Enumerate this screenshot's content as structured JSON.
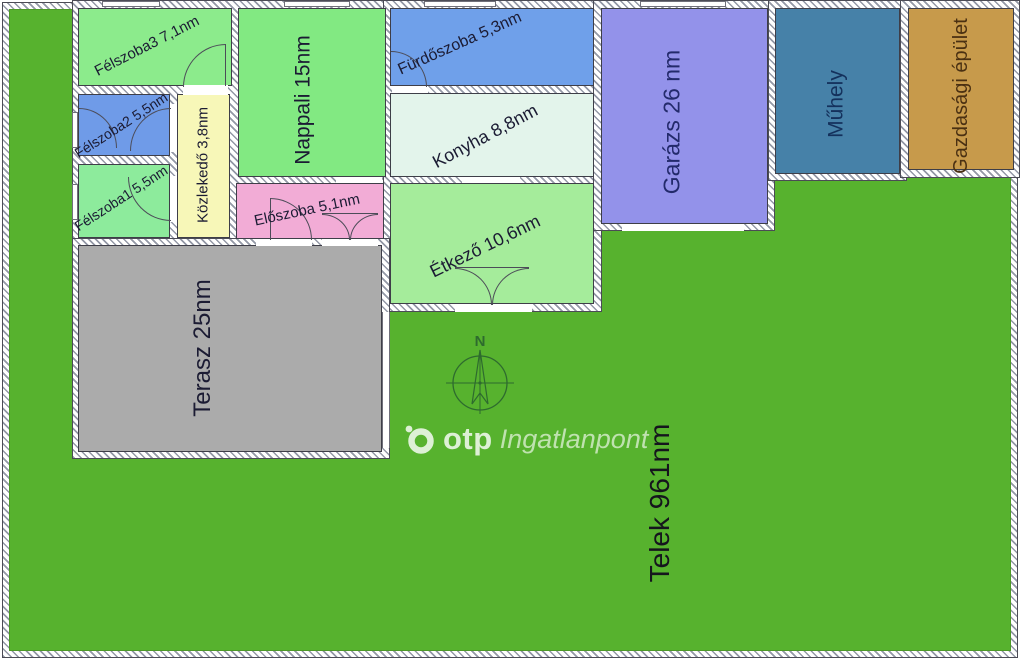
{
  "lot": {
    "label": "Telek 961nm",
    "lawn_color": "#57b22e"
  },
  "rooms": {
    "felszoba3": {
      "label": "Félszoba3 7,1nm",
      "fill": "#8ceb8c"
    },
    "felszoba2": {
      "label": "Félszoba2 5,5nm",
      "fill": "#6f9be8"
    },
    "felszoba1": {
      "label": "Félszoba1 5,5nm",
      "fill": "#8deb9c"
    },
    "kozlekedo": {
      "label": "Közlekedő 3,8nm",
      "fill": "#f7f7b8"
    },
    "nappali": {
      "label": "Nappali 15nm",
      "fill": "#82e982"
    },
    "eloszoba": {
      "label": "Előszoba 5,1nm",
      "fill": "#f2acd6"
    },
    "furdoszoba": {
      "label": "Fürdőszoba 5,3nm",
      "fill": "#6fa0ea"
    },
    "konyha": {
      "label": "Konyha 8,8nm",
      "fill": "#e3f4eb"
    },
    "etkezo": {
      "label": "Étkező 10,6nm",
      "fill": "#a5ec9b"
    },
    "garazs": {
      "label": "Garázs 26 nm",
      "fill": "#9392ea",
      "text": "#232a6b"
    },
    "muhely": {
      "label": "Műhely",
      "fill": "#4681a8",
      "text": "#14315c"
    },
    "gazdasagi": {
      "label": "Gazdasági épület",
      "fill": "#c79a4b",
      "text": "#4a3012"
    },
    "terasz": {
      "label": "Terasz 25nm",
      "fill": "#ababab"
    }
  },
  "compass": {
    "north": "N"
  },
  "watermark": {
    "brand": "otp",
    "suffix": "Ingatlanpont"
  }
}
